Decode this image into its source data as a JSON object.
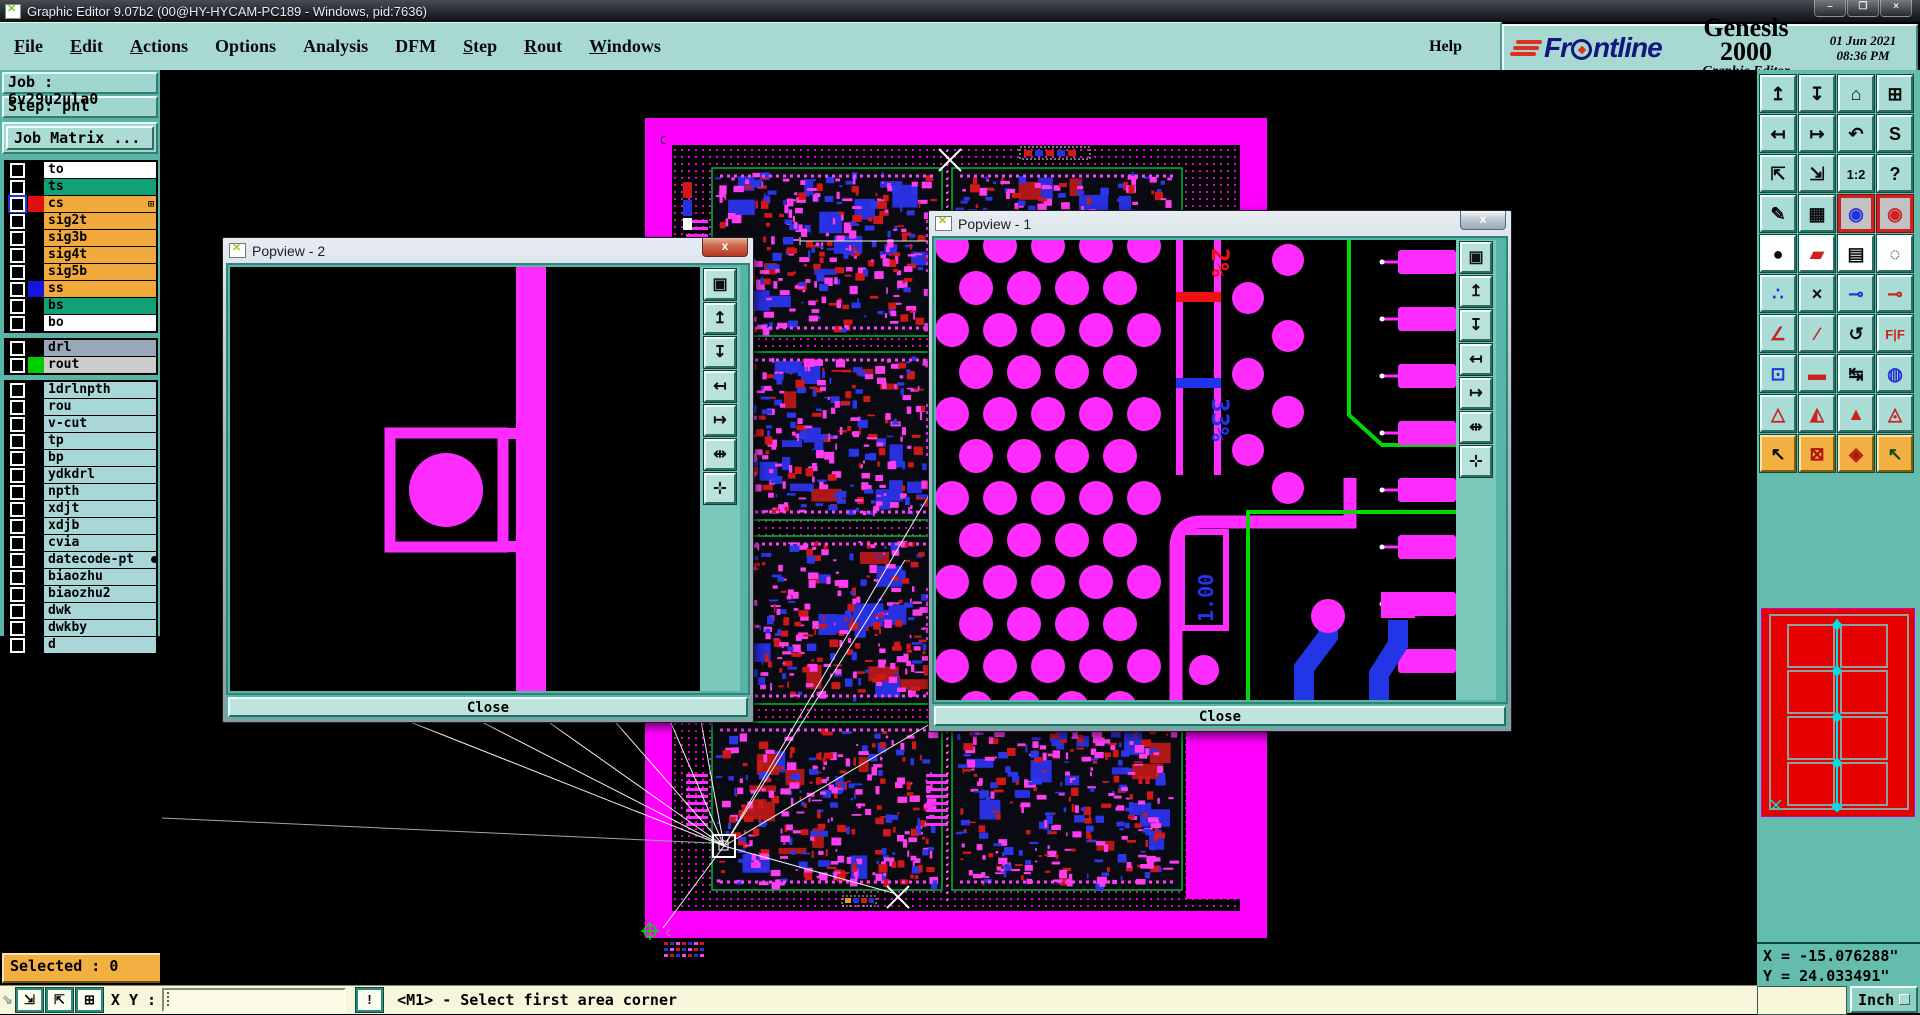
{
  "window": {
    "title": "Graphic Editor 9.07b2 (00@HY-HYCAM-PC189 - Windows, pid:7636)",
    "controls": [
      {
        "name": "minimize-button",
        "glyph": "–"
      },
      {
        "name": "restore-button",
        "glyph": "❐"
      },
      {
        "name": "close-button",
        "glyph": "×"
      }
    ]
  },
  "menu": {
    "items": [
      {
        "label": "File",
        "u": 0
      },
      {
        "label": "Edit",
        "u": 0
      },
      {
        "label": "Actions",
        "u": 0
      },
      {
        "label": "Options"
      },
      {
        "label": "Analysis"
      },
      {
        "label": "DFM"
      },
      {
        "label": "Step",
        "u": 0
      },
      {
        "label": "Rout",
        "u": 0
      },
      {
        "label": "Windows",
        "u": 0
      }
    ],
    "help": "Help"
  },
  "brand": {
    "name": "Frontline",
    "product": "Genesis 2000",
    "subtitle": "Graphic Editor",
    "date": "01 Jun 2021",
    "time": "08:36 PM"
  },
  "job": {
    "job_line": "Job : 6v29u2ula0",
    "step_line": "Step: pnl",
    "matrix_button": "Job Matrix ..."
  },
  "layers": [
    {
      "name": "to",
      "bg": "#ffffff",
      "swatch": "#000000",
      "group": 1
    },
    {
      "name": "ts",
      "bg": "#12a176",
      "swatch": "#000000",
      "group": 1
    },
    {
      "name": "cs",
      "bg": "#f2a93c",
      "swatch": "#e01010",
      "group": 1,
      "active": true,
      "grid": true
    },
    {
      "name": "sig2t",
      "bg": "#f2a93c",
      "swatch": "#000000",
      "group": 1
    },
    {
      "name": "sig3b",
      "bg": "#f2a93c",
      "swatch": "#000000",
      "group": 1
    },
    {
      "name": "sig4t",
      "bg": "#f2a93c",
      "swatch": "#000000",
      "group": 1
    },
    {
      "name": "sig5b",
      "bg": "#f2a93c",
      "swatch": "#000000",
      "group": 1
    },
    {
      "name": "ss",
      "bg": "#f2a93c",
      "swatch": "#1515dd",
      "group": 1
    },
    {
      "name": "bs",
      "bg": "#12a176",
      "swatch": "#000000",
      "group": 1
    },
    {
      "name": "bo",
      "bg": "#ffffff",
      "swatch": "#000000",
      "group": 1
    },
    {
      "name": "drl",
      "bg": "#97a9b9",
      "swatch": "#000000",
      "group": 2
    },
    {
      "name": "rout",
      "bg": "#cccccc",
      "swatch": "#00cc00",
      "group": 2
    },
    {
      "name": "1drlnpth",
      "bg": "#a9d6d6",
      "swatch": "#000000",
      "group": 3
    },
    {
      "name": "rou",
      "bg": "#a9d6d6",
      "swatch": "#000000",
      "group": 3
    },
    {
      "name": "v-cut",
      "bg": "#a9d6d6",
      "swatch": "#000000",
      "group": 3
    },
    {
      "name": "tp",
      "bg": "#a9d6d6",
      "swatch": "#000000",
      "group": 3
    },
    {
      "name": "bp",
      "bg": "#a9d6d6",
      "swatch": "#000000",
      "group": 3
    },
    {
      "name": "ydkdrl",
      "bg": "#a9d6d6",
      "swatch": "#000000",
      "group": 3
    },
    {
      "name": "npth",
      "bg": "#a9d6d6",
      "swatch": "#000000",
      "group": 3
    },
    {
      "name": "xdjt",
      "bg": "#a9d6d6",
      "swatch": "#000000",
      "group": 3
    },
    {
      "name": "xdjb",
      "bg": "#a9d6d6",
      "swatch": "#000000",
      "group": 3
    },
    {
      "name": "cvia",
      "bg": "#a9d6d6",
      "swatch": "#000000",
      "group": 3
    },
    {
      "name": "datecode-pt",
      "bg": "#a9d6d6",
      "swatch": "#000000",
      "group": 3,
      "trunc": true
    },
    {
      "name": "biaozhu",
      "bg": "#a9d6d6",
      "swatch": "#000000",
      "group": 3
    },
    {
      "name": "biaozhu2",
      "bg": "#a9d6d6",
      "swatch": "#000000",
      "group": 3
    },
    {
      "name": "dwk",
      "bg": "#a9d6d6",
      "swatch": "#000000",
      "group": 3
    },
    {
      "name": "dwkby",
      "bg": "#a9d6d6",
      "swatch": "#000000",
      "group": 3
    },
    {
      "name": "d",
      "bg": "#a9d6d6",
      "swatch": "#000000",
      "group": 3
    }
  ],
  "toolbar": {
    "buttons": [
      {
        "name": "pan-up-window-button",
        "glyph": "↥",
        "kind": "teal"
      },
      {
        "name": "pan-down-window-button",
        "glyph": "↧",
        "kind": "teal"
      },
      {
        "name": "zoom-home-button",
        "glyph": "⌂",
        "kind": "teal"
      },
      {
        "name": "zoom-window-xy-button",
        "glyph": "⊞",
        "kind": "teal"
      },
      {
        "name": "pan-left-button",
        "glyph": "↤",
        "kind": "teal"
      },
      {
        "name": "pan-right-button",
        "glyph": "↦",
        "kind": "teal"
      },
      {
        "name": "zoom-previous-button",
        "glyph": "↶",
        "kind": "teal"
      },
      {
        "name": "zoom-sequence-button",
        "glyph": "S",
        "kind": "teal"
      },
      {
        "name": "zoom-out-button",
        "glyph": "⇱",
        "kind": "teal"
      },
      {
        "name": "zoom-in-button",
        "glyph": "⇲",
        "kind": "teal"
      },
      {
        "name": "zoom-1-2-button",
        "glyph": "1:2",
        "kind": "teal",
        "small": true
      },
      {
        "name": "query-button",
        "glyph": "?",
        "kind": "teal"
      },
      {
        "name": "setup-tools-button",
        "glyph": "✎",
        "kind": "teal"
      },
      {
        "name": "grid-toggle-button",
        "glyph": "▦",
        "kind": "teal"
      },
      {
        "name": "display-profile-1-button",
        "glyph": "◉",
        "kind": "red",
        "fg": "#2233dd"
      },
      {
        "name": "display-profile-2-button",
        "glyph": "◉",
        "kind": "red",
        "fg": "#cc2222"
      },
      {
        "name": "select-feature-button",
        "glyph": "●",
        "kind": "white"
      },
      {
        "name": "edit-shapes-button",
        "glyph": "▰",
        "kind": "white",
        "fg": "#cc2222"
      },
      {
        "name": "measure-ruler-button",
        "glyph": "▤",
        "kind": "white"
      },
      {
        "name": "select-pad-button",
        "glyph": "◌",
        "kind": "white"
      },
      {
        "name": "net-points-button",
        "glyph": "∴",
        "kind": "teal",
        "fg": "#2233dd"
      },
      {
        "name": "delete-button",
        "glyph": "×",
        "kind": "teal"
      },
      {
        "name": "copy-open-button",
        "glyph": "⊸",
        "kind": "teal",
        "fg": "#2233dd"
      },
      {
        "name": "copy-filled-button",
        "glyph": "⊸",
        "kind": "teal",
        "fg": "#cc2222"
      },
      {
        "name": "measure-angle-button",
        "glyph": "∠",
        "kind": "teal",
        "fg": "#cc2222"
      },
      {
        "name": "measure-slope-button",
        "glyph": "∕",
        "kind": "teal",
        "fg": "#cc2222"
      },
      {
        "name": "rotate-button",
        "glyph": "↺",
        "kind": "teal"
      },
      {
        "name": "mirror-button",
        "glyph": "F|F",
        "kind": "teal",
        "small": true,
        "fg": "#cc2222"
      },
      {
        "name": "copy-pad-button",
        "glyph": "⊡",
        "kind": "teal",
        "fg": "#2233dd"
      },
      {
        "name": "stretch-line-button",
        "glyph": "▬",
        "kind": "teal",
        "fg": "#cc2222"
      },
      {
        "name": "dimension-button",
        "glyph": "↹",
        "kind": "teal"
      },
      {
        "name": "merge-pads-button",
        "glyph": "◍",
        "kind": "teal",
        "fg": "#2233dd"
      },
      {
        "name": "triangle-outline-button",
        "glyph": "△",
        "kind": "teal",
        "fg": "#cc2222"
      },
      {
        "name": "triangle-double-button",
        "glyph": "◭",
        "kind": "teal",
        "fg": "#cc2222"
      },
      {
        "name": "triangle-filled-button",
        "glyph": "▲",
        "kind": "teal",
        "fg": "#cc2222"
      },
      {
        "name": "triangle-wide-button",
        "glyph": "◬",
        "kind": "teal",
        "fg": "#cc2222"
      },
      {
        "name": "cursor-select-button",
        "glyph": "↖",
        "kind": "orange"
      },
      {
        "name": "cursor-area-button",
        "glyph": "⊠",
        "kind": "orange",
        "fg": "#b01010"
      },
      {
        "name": "cursor-polygon-button",
        "glyph": "◈",
        "kind": "orange",
        "fg": "#b01010"
      },
      {
        "name": "cursor-net-button",
        "glyph": "↖",
        "kind": "orange",
        "fg": "#104a10"
      }
    ]
  },
  "popview_tools": [
    {
      "name": "popout-window-icon",
      "glyph": "▣"
    },
    {
      "name": "pan-up-icon",
      "glyph": "↥"
    },
    {
      "name": "pan-down-icon",
      "glyph": "↧"
    },
    {
      "name": "pan-left-icon",
      "glyph": "↤"
    },
    {
      "name": "pan-right-icon",
      "glyph": "↦"
    },
    {
      "name": "zoom-fit-icon",
      "glyph": "⇹"
    },
    {
      "name": "zoom-center-icon",
      "glyph": "⊹"
    }
  ],
  "popview2": {
    "title": "Popview - 2",
    "close": "Close"
  },
  "popview1": {
    "title": "Popview - 1",
    "close": "Close",
    "labels": {
      "top_percent": "2%",
      "mid_percent": "33%",
      "value": "1.00"
    }
  },
  "board_marks": {
    "corner_letter_top": "C",
    "corner_letter_bottom": "C"
  },
  "coords": {
    "x_line": "X = -15.076288\"",
    "y_line": "Y = 24.033491\""
  },
  "units": {
    "label": "Inch"
  },
  "status": {
    "selected": "Selected : 0",
    "xy_label": "X Y :",
    "xy_value": "",
    "message": "<M1> - Select first area corner",
    "buttons": [
      {
        "name": "resize-corner-icon",
        "glyph": "⇲"
      },
      {
        "name": "measure-diagonal-icon",
        "glyph": "⇱"
      },
      {
        "name": "tile-windows-icon",
        "glyph": "⊞"
      }
    ],
    "alert_glyph": "!"
  },
  "colors": {
    "ui_teal": "#a7d8d2",
    "panel_teal": "#58b5a5",
    "board_magenta": "#ff00ff",
    "overview_red": "#e60000",
    "overview_grey": "#8fa0a0",
    "overview_cyan": "#00e0e0",
    "selected_orange": "#f2b042",
    "statusbar_yellow": "#f6f6da",
    "trace_blue": "#2236e8",
    "trace_green": "#00d800",
    "clutter_red": "#d01818"
  }
}
